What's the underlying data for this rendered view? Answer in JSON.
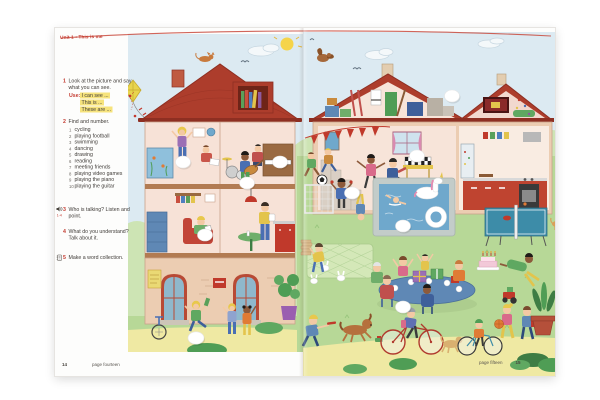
{
  "header": {
    "unit_label": "Unit 1 • This is me"
  },
  "exercises": {
    "ex1": {
      "number": "1",
      "text": "Look at the picture and say what you can see.",
      "use_label": "Use:",
      "phrases": [
        "I can see ...",
        "This is ...",
        "These are ..."
      ]
    },
    "ex2": {
      "number": "2",
      "text": "Find and number.",
      "items": [
        {
          "num": "1",
          "label": "cycling"
        },
        {
          "num": "2",
          "label": "playing football"
        },
        {
          "num": "3",
          "label": "swimming"
        },
        {
          "num": "4",
          "label": "dancing"
        },
        {
          "num": "5",
          "label": "drawing"
        },
        {
          "num": "6",
          "label": "reading"
        },
        {
          "num": "7",
          "label": "meeting friends"
        },
        {
          "num": "8",
          "label": "playing video games"
        },
        {
          "num": "9",
          "label": "playing the piano"
        },
        {
          "num": "10",
          "label": "playing the guitar"
        }
      ]
    },
    "ex3": {
      "number": "3",
      "text": "Who is talking? Listen and point.",
      "audio_track": "1-4"
    },
    "ex4": {
      "number": "4",
      "text": "What do you understand? Talk about it."
    },
    "ex5": {
      "number": "5",
      "text": "Make a word collection."
    }
  },
  "footer": {
    "left_page_number": "14",
    "left_label": "page fourteen",
    "right_label": "page fifteen",
    "right_page_number": "15"
  },
  "colors": {
    "accent_red": "#c3392e",
    "highlight_yellow": "#f6e37c",
    "sky": "#dceaf2",
    "grass": "#b7d897",
    "path_yellow": "#efe9a3",
    "roof_red": "#ad3d2c",
    "house_wall": "#eccdb2",
    "room_pink": "#f7e2d7",
    "pool_blue": "#6fa8cc"
  }
}
